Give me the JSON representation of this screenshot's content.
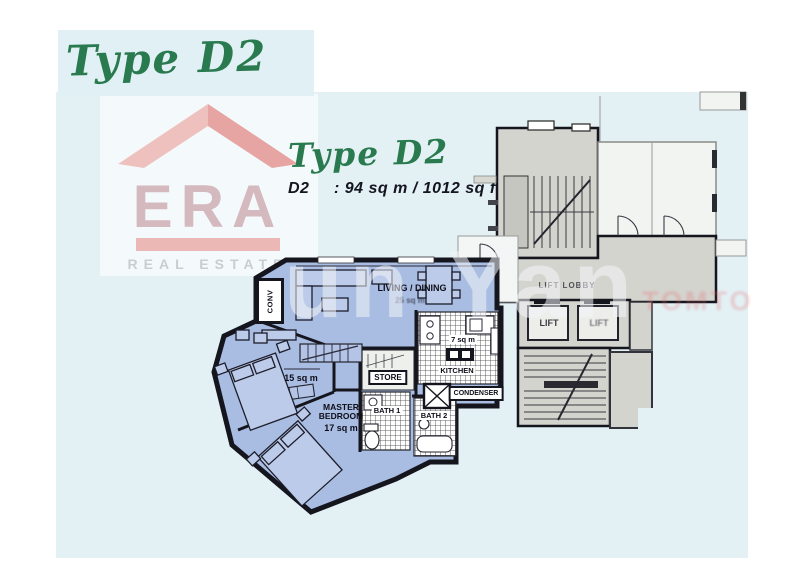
{
  "page": {
    "header_title": "Type D2"
  },
  "plan_header": {
    "title": "Type D2",
    "unit_code": "D2",
    "unit_spec": ": 94 sq m / 1012 sq ft"
  },
  "logo": {
    "brand": "ERA",
    "tagline": "REAL ESTATE"
  },
  "floorplan": {
    "labels": {
      "living_dining": "LIVING / DINING",
      "living_dining_area": "25 sq m",
      "bedroom2_area": "15 sq m",
      "master_bedroom": "MASTER BEDROOM",
      "master_bedroom_area": "17 sq m",
      "kitchen": "KITCHEN",
      "kitchen_area": "7 sq m",
      "store": "STORE",
      "bath1": "BATH 1",
      "bath2": "BATH 2",
      "condenser": "CONDENSER",
      "conv": "CONV",
      "lift_lobby": "LIFT LOBBY",
      "lift_left": "LIFT",
      "lift_right": "LIFT"
    },
    "colors": {
      "unit_fill": "#a9bde2",
      "common_fill": "#d4d4cf",
      "wall": "#15151e",
      "page_tint": "#e3f1f5",
      "accent_green": "#2a7a50"
    }
  },
  "watermarks": {
    "center": "un Yan",
    "side": "TOMTO"
  }
}
